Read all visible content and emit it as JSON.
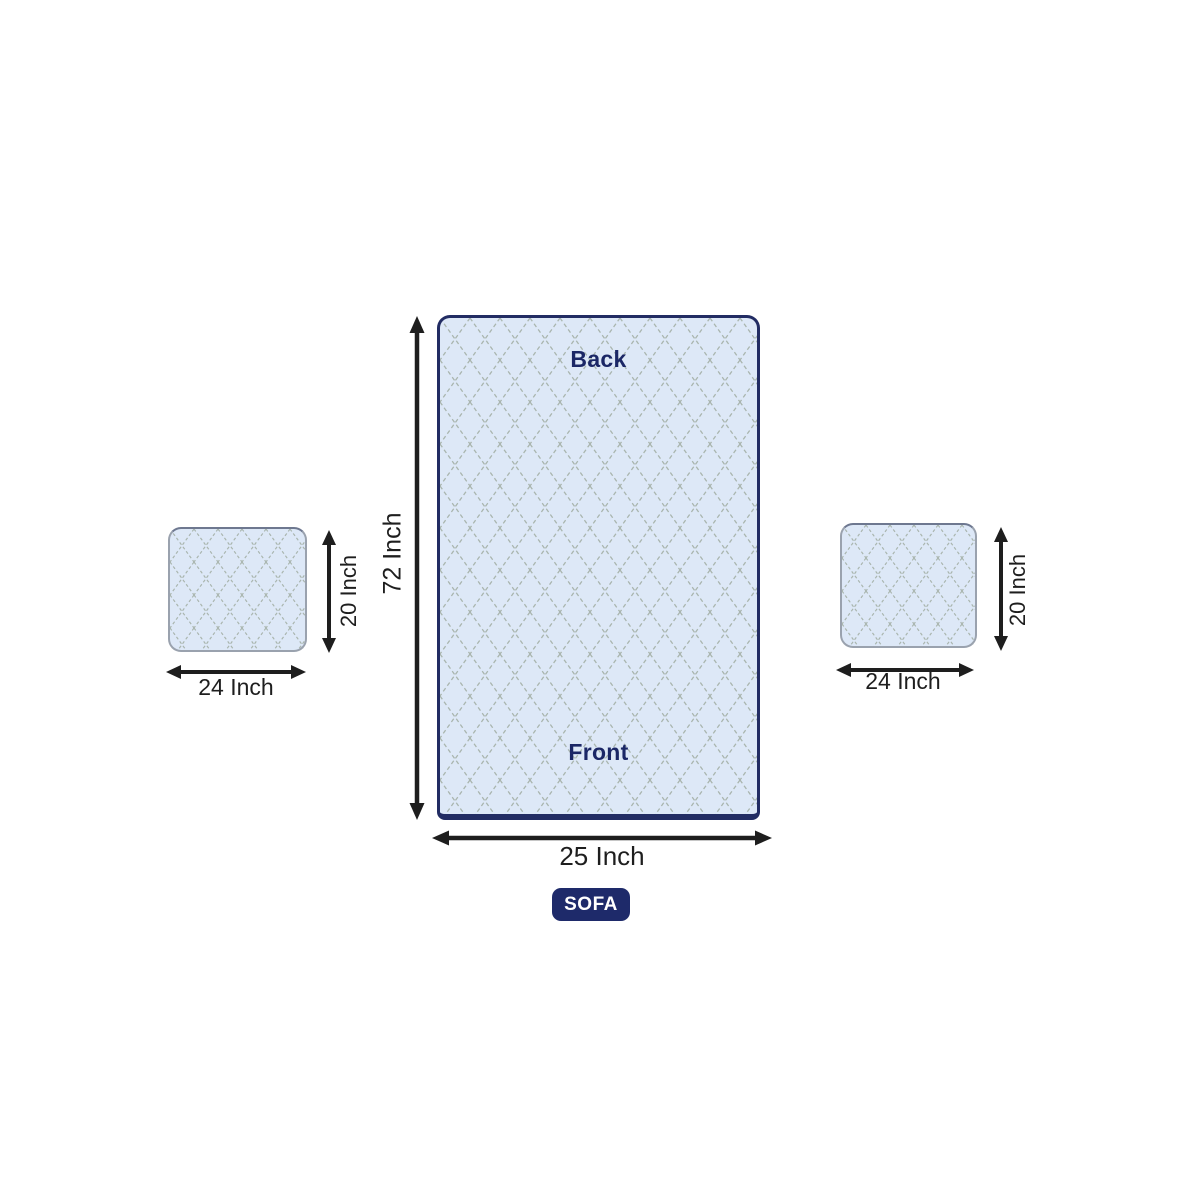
{
  "main_panel": {
    "back_label": "Back",
    "front_label": "Front",
    "height_label": "72 Inch",
    "width_label": "25 Inch"
  },
  "left_cushion": {
    "height_label": "20 Inch",
    "width_label": "24 Inch"
  },
  "right_cushion": {
    "height_label": "20 Inch",
    "width_label": "24 Inch"
  },
  "badge_label": "SOFA",
  "colors": {
    "panel_fill": "#dde8f7",
    "panel_border": "#222c63",
    "lattice_line": "#a9b5ae",
    "label_navy": "#1b2766",
    "dimension_black": "#1e1e1e",
    "badge_bg": "#1e2a6a",
    "badge_text": "#ffffff",
    "cushion_border": "#9aa2ae"
  }
}
